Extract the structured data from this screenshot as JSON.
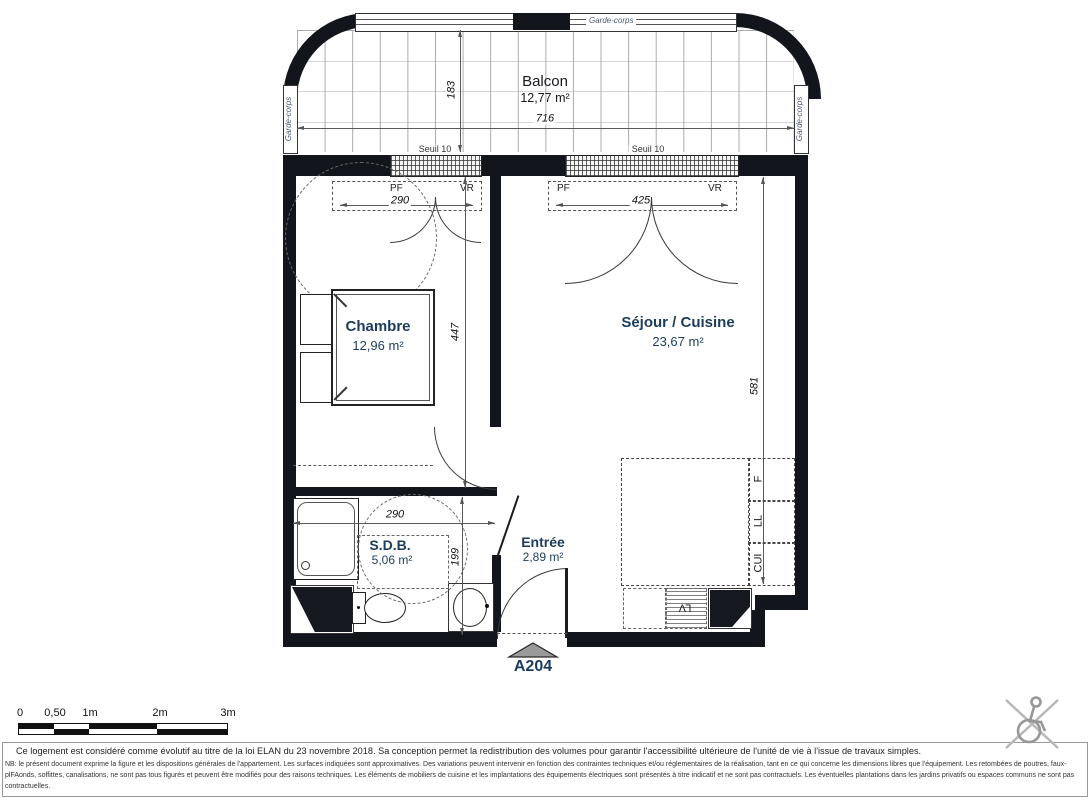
{
  "plan": {
    "unit": "A204",
    "rooms": {
      "balcon": {
        "name": "Balcon",
        "area": "12,77 m²"
      },
      "chambre": {
        "name": "Chambre",
        "area": "12,96 m²"
      },
      "sejour": {
        "name": "Séjour / Cuisine",
        "area": "23,67 m²"
      },
      "sdb": {
        "name": "S.D.B.",
        "area": "5,06 m²"
      },
      "entree": {
        "name": "Entrée",
        "area": "2,89 m²"
      }
    },
    "dims": {
      "balcony_depth": "183",
      "balcony_width": "716",
      "window1": "290",
      "window2": "425",
      "chambre_depth": "447",
      "sejour_depth": "581",
      "sdb_width": "290",
      "sdb_depth": "199"
    },
    "labels": {
      "garde_corps": "Garde-corps",
      "seuil": "Seuil 10",
      "pf": "PF",
      "vr": "VR",
      "f": "F",
      "ll": "LL",
      "cui": "CUI",
      "lv": "LV"
    },
    "colors": {
      "wall": "#12151c",
      "room_label": "#1c3c5c",
      "unit_label": "#1b3a5f"
    }
  },
  "scalebar": {
    "t0": "0",
    "t05": "0,50",
    "t1": "1m",
    "t2": "2m",
    "t3": "3m"
  },
  "footer": {
    "evolutif": "Ce logement est considéré comme évolutif au titre de la loi ELAN du 23 novembre 2018. Sa conception permet la redistribution des volumes pour garantir l'accessibilité ultérieure de l'unité de vie à l'issue de travaux simples.",
    "nb": "NB: le présent document exprime la figure et les dispositions générales de l'appartement. Les surfaces indiquées sont approximatives. Des variations peuvent intervenir en fonction des contraintes techniques et/ou réglementaires de la réalisation, tant en ce qui concerne les dimensions libres que l'équipement. Les retombées de poutres, faux-plFAonds, soffittes, canalisations, ne sont pas tous figurés et peuvent être modifiés pour des raisons techniques. Les éléments de mobiliers de cuisine et les implantations des équipements électriques sont présentés à titre indicatif et ne sont pas contractuels. Les éventuelles plantations dans les jardins privatifs ou espaces communs ne sont pas contractuelles."
  }
}
